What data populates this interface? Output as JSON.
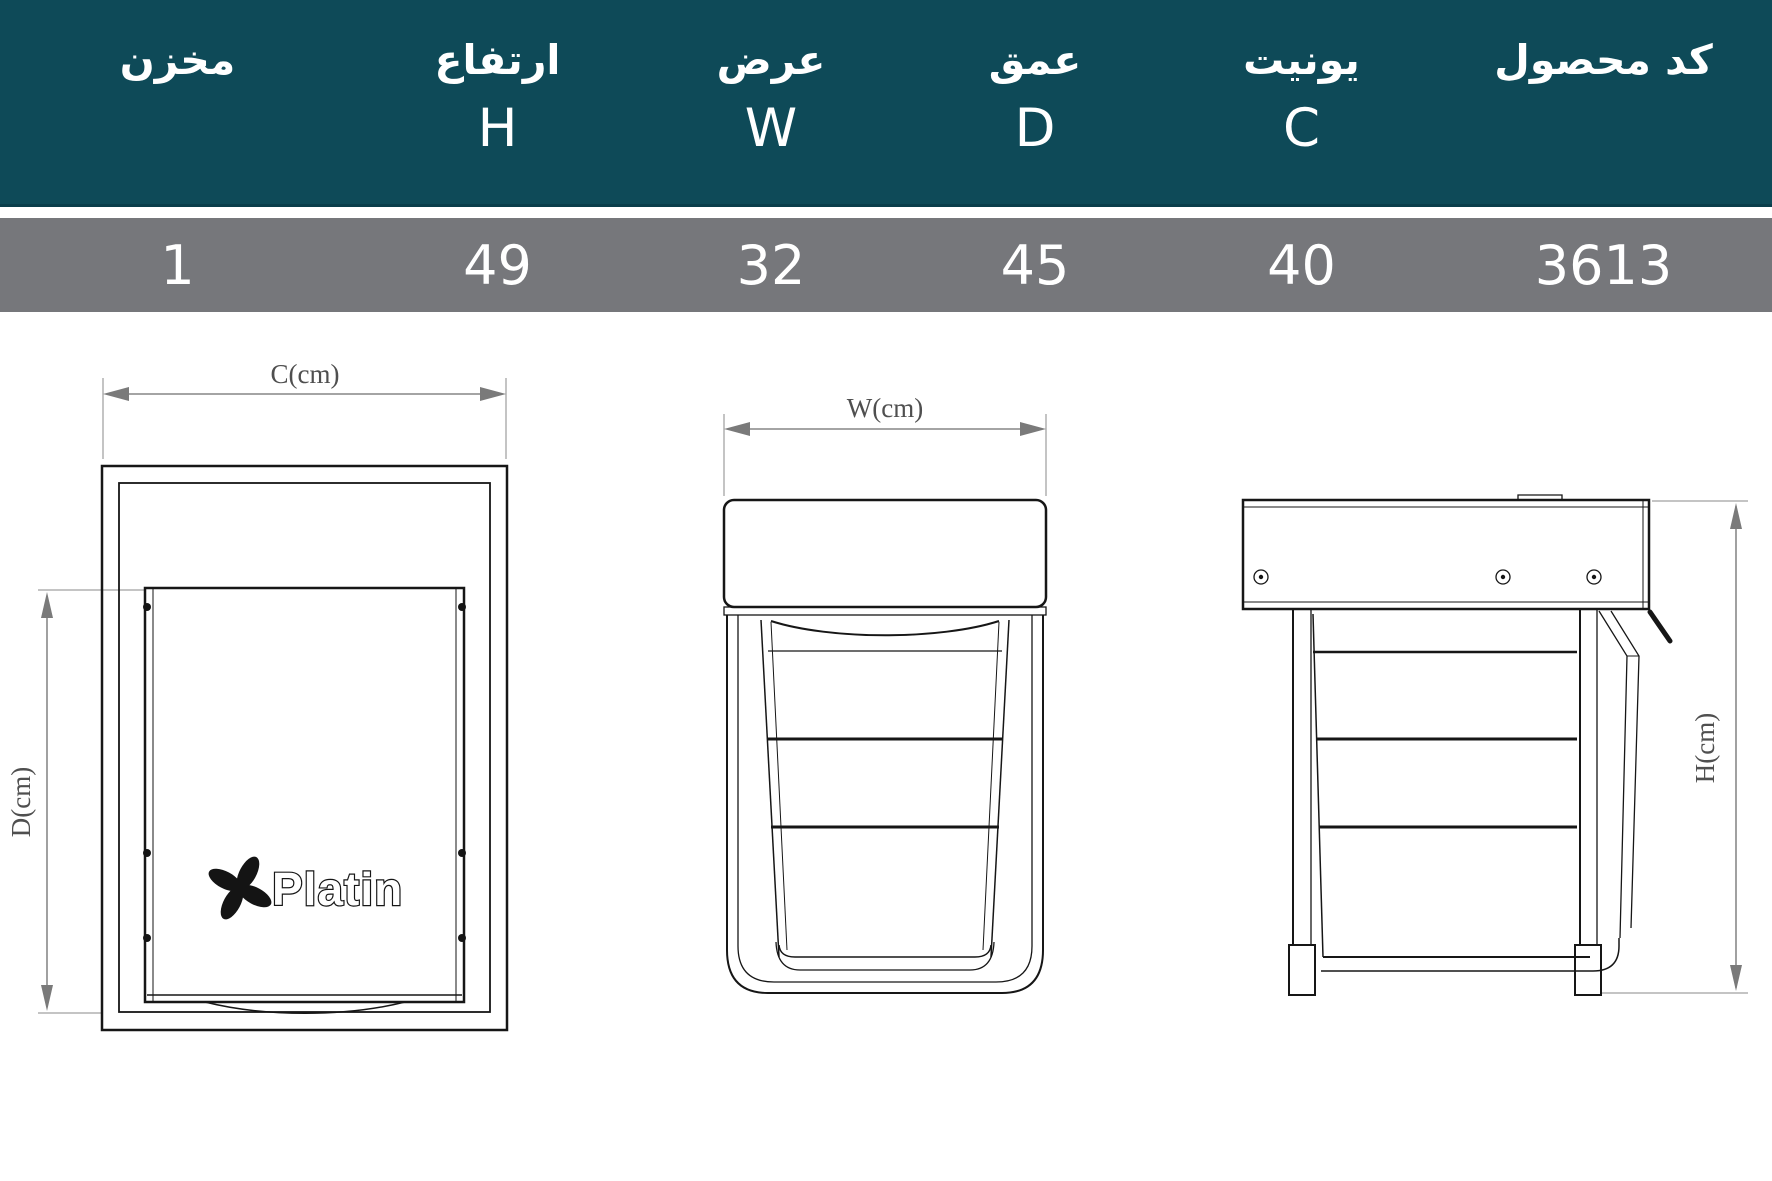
{
  "header": {
    "columns": [
      {
        "label": "مخزن",
        "letter": "",
        "value": "1"
      },
      {
        "label": "ارتفاع",
        "letter": "H",
        "value": "49"
      },
      {
        "label": "عرض",
        "letter": "W",
        "value": "32"
      },
      {
        "label": "عمق",
        "letter": "D",
        "value": "45"
      },
      {
        "label": "یونیت",
        "letter": "C",
        "value": "40"
      },
      {
        "label": "کد محصول",
        "letter": "",
        "value": "3613"
      }
    ]
  },
  "colors": {
    "header_bg": "#0E4A58",
    "row_bg": "#76777B",
    "line": "#161616",
    "dimension": "#6e6e6e"
  },
  "drawings": {
    "front_view": {
      "width_dim_label": "C(cm)",
      "depth_dim_label": "D(cm)",
      "logo_text": "Platin"
    },
    "unit_view": {
      "width_dim_label": "W(cm)"
    },
    "side_view": {
      "height_dim_label": "H(cm)"
    }
  }
}
